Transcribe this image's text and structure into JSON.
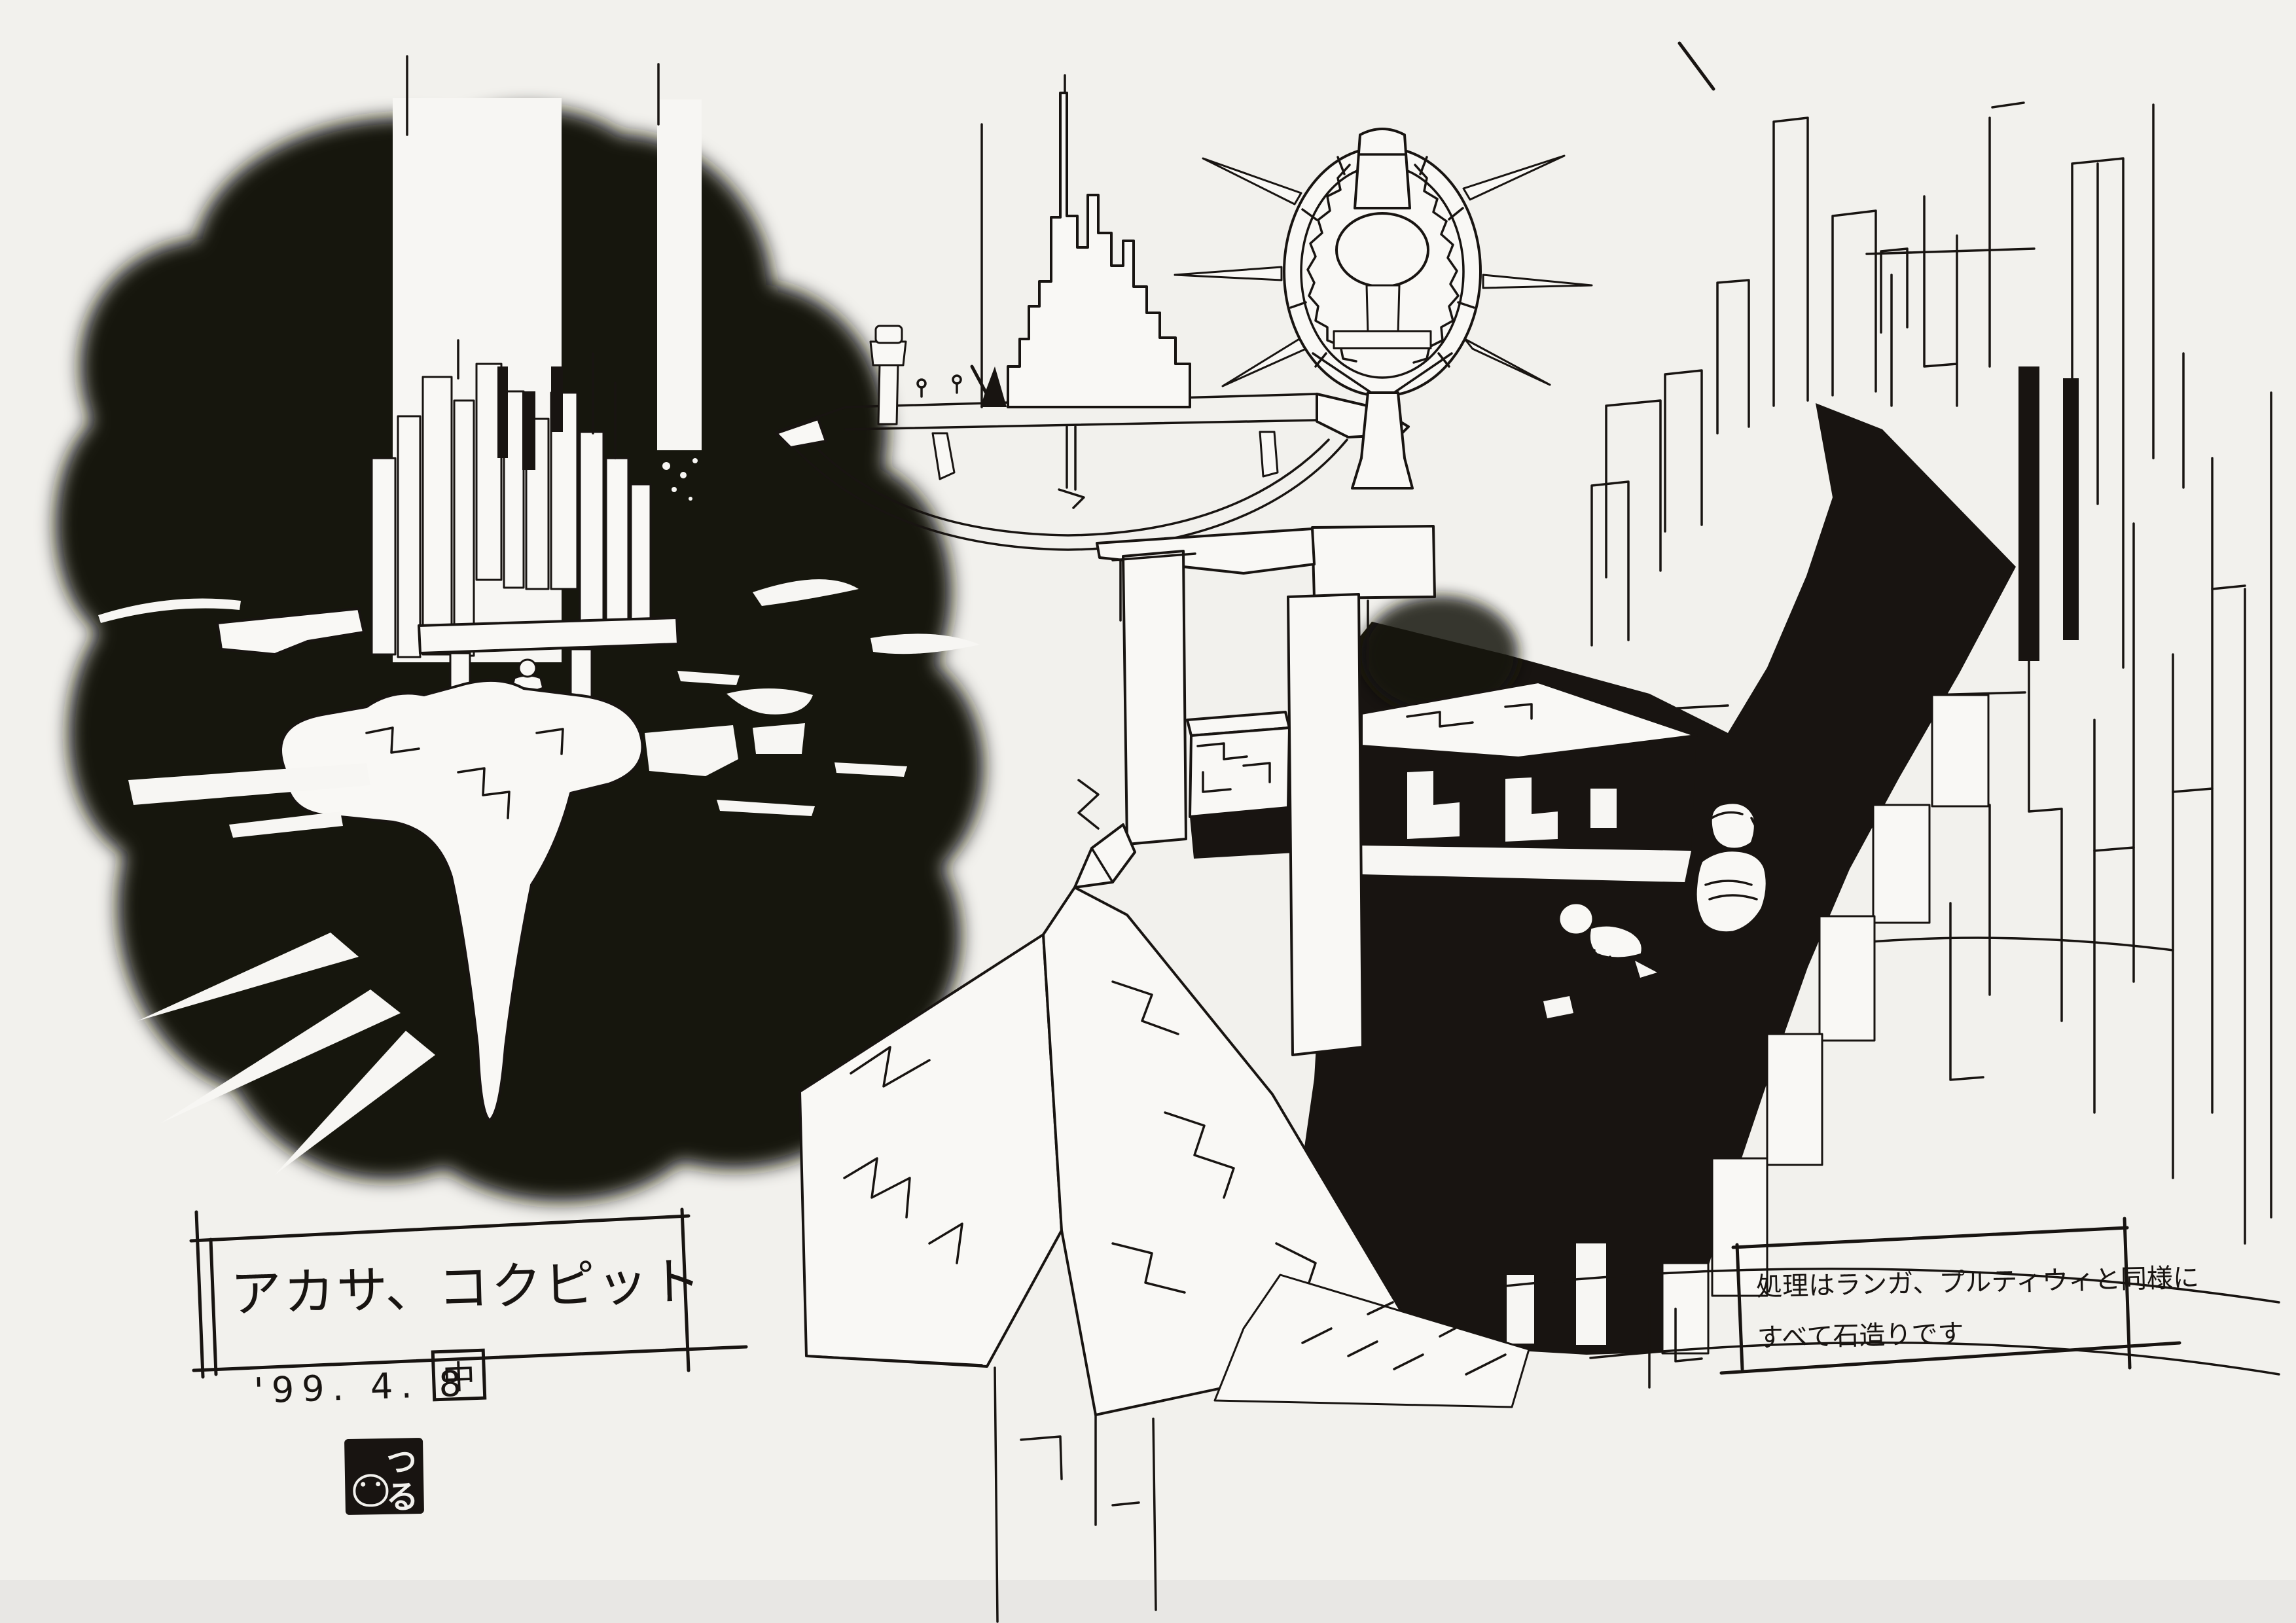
{
  "page": {
    "paper_color": "#f2f1ed",
    "ink_color": "#181411",
    "bottom_edge_color": "#e8e7e4"
  },
  "title_block": {
    "title": "アカサ、コクピット",
    "date": "'99. 4. 8",
    "approval_mark": "中"
  },
  "note_block": {
    "line1": "処理はランガ、プルティウィと同様に",
    "line2": "すべて石造りです"
  },
  "artist_stamp": {
    "reading": "つる",
    "char_top": "つ",
    "char_bottom": "る"
  }
}
